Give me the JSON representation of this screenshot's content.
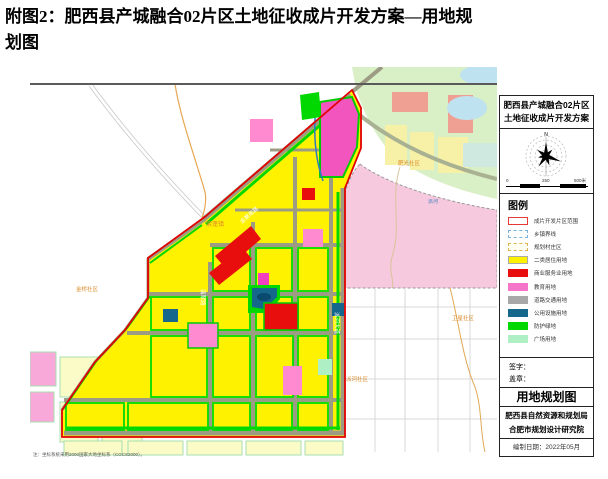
{
  "page": {
    "title_line1": "附图2：肥西县产城融合02片区土地征收成片开发方案—用地规",
    "title_line2": "划图"
  },
  "map": {
    "labels": {
      "town_left": "紫蓬镇",
      "community_bottom_left": "金桥社区",
      "community_right_upper": "肥光社区",
      "community_right_lower": "卫星社区",
      "community_bottom_right": "派河社区",
      "river": "派河",
      "road_diagonal": "金寨南路",
      "road_west": "翡翠路",
      "road_east": "派河大道",
      "footnote": "注：坐标系统采用2000国家大地坐标系（CGCS2000）。"
    },
    "colors": {
      "residential": "#fff200",
      "commercial": "#e90e0e",
      "education": "#f576c8",
      "utility": "#15688c",
      "green_buffer": "#00d800",
      "plaza": "#afefc4",
      "road": "#9c9c84",
      "boundary_red": "#e10000",
      "outside_green": "#d9efc6",
      "outside_pink": "#f7c9df"
    }
  },
  "panel": {
    "title_line1": "肥西县产城融合02片区",
    "title_line2": "土地征收成片开发方案",
    "compass_north": "N",
    "scale_labels": [
      "0",
      "250",
      "500米"
    ],
    "legend_title": "图例",
    "legend_items": [
      {
        "label": "成片开发片区范围",
        "color": "#ffffff"
      },
      {
        "label": "乡镇界线",
        "color": "#7ab4dc"
      },
      {
        "label": "规划村庄区",
        "color": "#e0b54e"
      },
      {
        "label": "二类居住用地",
        "color": "#fff200"
      },
      {
        "label": "商业服务业用地",
        "color": "#e90e0e"
      },
      {
        "label": "教育用地",
        "color": "#f576c8"
      },
      {
        "label": "道路交通用地",
        "color": "#a8a8a8"
      },
      {
        "label": "公用设施用地",
        "color": "#15688c"
      },
      {
        "label": "防护绿地",
        "color": "#00d800"
      },
      {
        "label": "广场用地",
        "color": "#afefc4"
      }
    ],
    "sign_label": "签字：",
    "seal_label": "盖章：",
    "block_title": "用地规划图",
    "org_line1": "肥西县自然资源和规划局",
    "org_line2": "合肥市规划设计研究院",
    "date_line": "编制日期：2022年05月"
  }
}
